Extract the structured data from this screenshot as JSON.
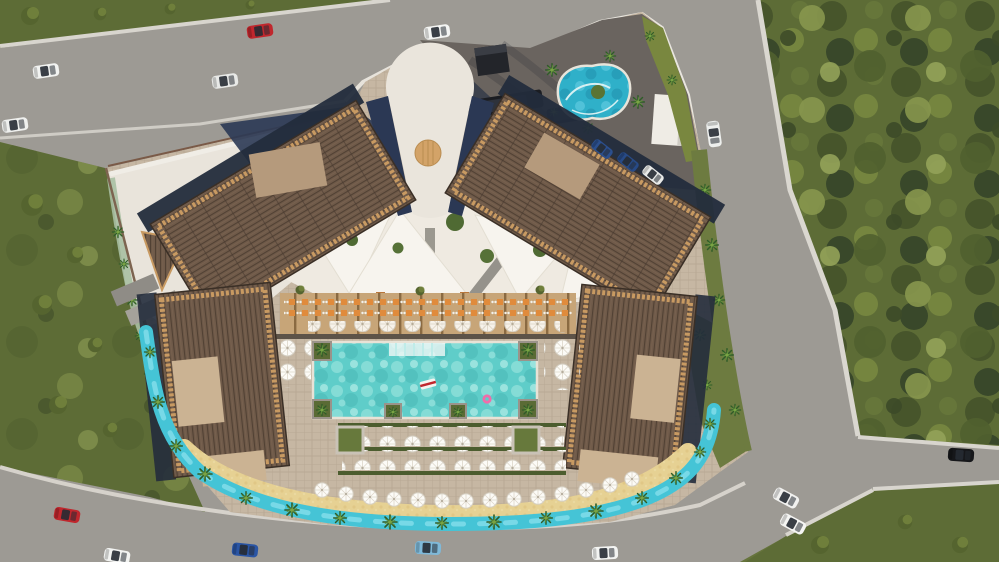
{
  "scene": {
    "type": "aerial-architectural-render",
    "description": "Top-down 3D visualization of a seaside resort: four wood-slat-roof buildings around a central courtyard with shade sails, a rectangular main pool with floats, a free-form kids lagoon, a perimeter lazy river with palm islands, a sand beach strip with white umbrellas, a pergola dining terrace, an arrival plaza with a round timber deck, surrounded by roads, lawns and tree fields with cars"
  },
  "features": {
    "buildings_count": 4,
    "entrance": "fan-shaped arrival plaza with circular timber deck",
    "main_pool": "rectangular swimming pool with white float and pink ring float",
    "kids_lagoon": "free-form lagoon pool with green island",
    "lazy_river": "turquoise lazy river looping the south perimeter",
    "beach": "golden sand strip with rows of white umbrellas",
    "dining_terrace": "pergola terrace with orange tables and white chairs",
    "courtyard": "white shade sails over cream plaza",
    "parking": "dark asphalt forecourt with two shuttle buses and parked cars"
  },
  "colors": {
    "grass": "#66743c",
    "grass_field": "#5d6c36",
    "lawn_bright": "#79873f",
    "road": "#9d9a94",
    "sidewalk": "#d8d5ce",
    "parking": "#6a645f",
    "paver": "#c6b7a3",
    "plaza_white": "#e9e4db",
    "courtyard": "#efeae1",
    "sail": "#f7f4ee",
    "roof_dark": "#6f5a49",
    "roof_trim": "#c89a62",
    "canopy_tan": "#b59a7c",
    "canopy_light": "#cbb393",
    "navy_shadow": "#2b3854",
    "pool_water": "#5fcdc9",
    "lagoon_water": "#2fb0c9",
    "river_water": "#45c4d6",
    "sand": "#e6d193",
    "hedge": "#4c5d2f",
    "palm": "#2f5c28",
    "wood_disc": "#d3a368",
    "dining_wood": "#c7a578",
    "table_orange": "#e08b3c",
    "umbrella_white": "#fcfbf7"
  },
  "vehicles": {
    "cars": [
      {
        "label": "red car top road",
        "hex": "#c0272d"
      },
      {
        "label": "white car upper-left road",
        "hex": "#f2f3f1"
      },
      {
        "label": "white car left road",
        "hex": "#e8e9e7"
      },
      {
        "label": "white car lower-left road",
        "hex": "#eff0ee"
      },
      {
        "label": "white car top road",
        "hex": "#f4f5f3"
      },
      {
        "label": "white car right road",
        "hex": "#edefed"
      },
      {
        "label": "black car east road",
        "hex": "#16171a"
      },
      {
        "label": "white car junction 1",
        "hex": "#f1f1ef"
      },
      {
        "label": "white car junction 2",
        "hex": "#f5f5f3"
      },
      {
        "label": "red car bottom road",
        "hex": "#c0272d"
      },
      {
        "label": "white car bottom road 1",
        "hex": "#f2f3f1"
      },
      {
        "label": "blue car bottom road",
        "hex": "#2a55a4"
      },
      {
        "label": "light blue car bottom road",
        "hex": "#7fb9d9"
      },
      {
        "label": "white car bottom road 2",
        "hex": "#f3f4f2"
      },
      {
        "label": "parked blue car 1",
        "hex": "#2b4f8e"
      },
      {
        "label": "parked blue car 2",
        "hex": "#274a86"
      },
      {
        "label": "parked silver car",
        "hex": "#e9eae8"
      }
    ],
    "buses": 2
  }
}
